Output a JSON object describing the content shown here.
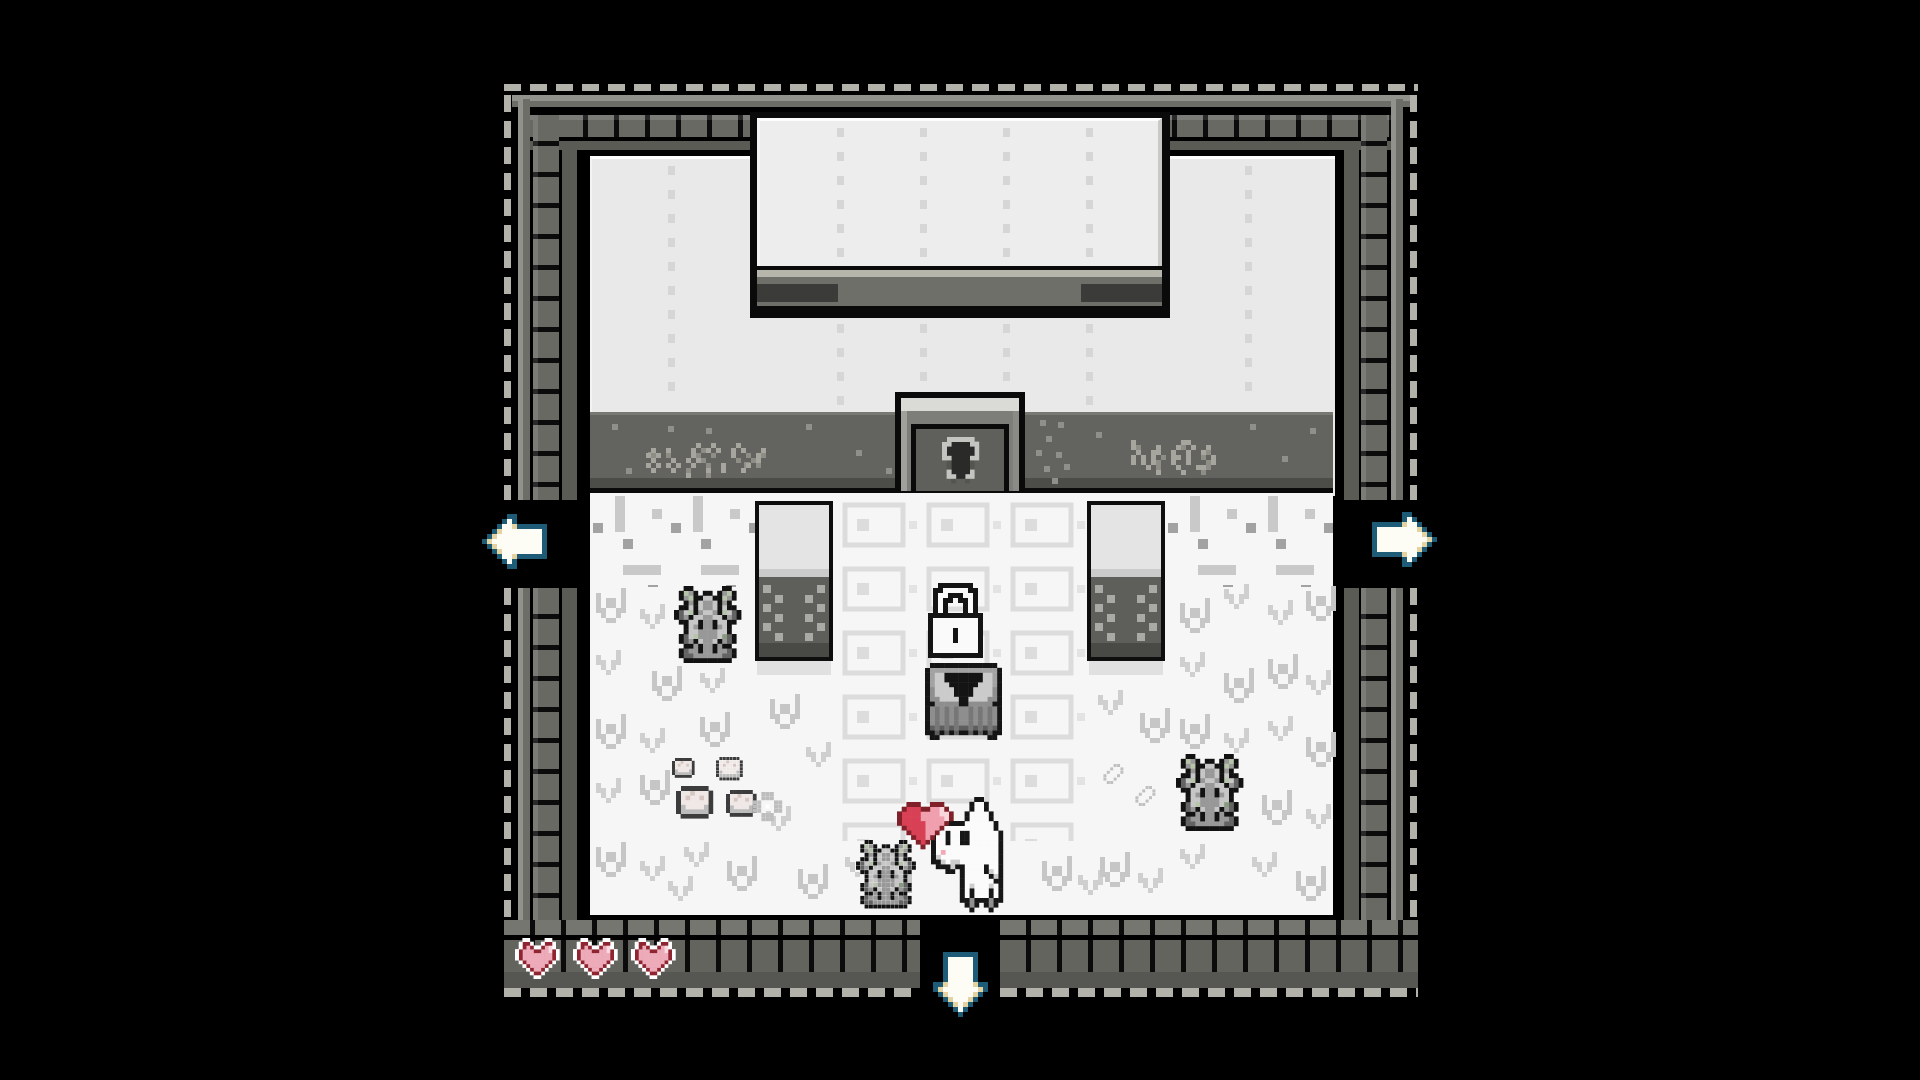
{
  "game": {
    "hud_hearts": 3,
    "door_locked": true,
    "exits": [
      "left",
      "right",
      "down"
    ]
  },
  "palette": {
    "background": "#000000",
    "frame_dash": "#b2b2aa",
    "frame_brick": "#696964",
    "wall": "#e9e9e9",
    "porch": "#63635f",
    "floor": "#f6f6f6",
    "heart_red": "#d84055",
    "heart_pink": "#f09fae",
    "hud_heart_ring": "#8f2531",
    "arrow_outline": "#1d5b76",
    "arrow_fill": "#fdfdf6",
    "arrow_tan": "#e4d2a0",
    "moss_green": "#b6c4aa"
  },
  "hud": {
    "hearts": 3,
    "x": 515,
    "y": 938,
    "spacing": 58,
    "scale": 3.7
  },
  "sprites": {
    "lock": {
      "palette": {
        "k": "#141414",
        "w": "#fafafa"
      },
      "rows": [
        "..kkkkkkk..",
        ".kkwwwwwkk.",
        ".kwwkkkwwk.",
        ".kwkk.kkwk.",
        ".kwk...kwk.",
        ".kwk...kwk.",
        "kkkkkkkkkkk",
        "kwwwwwwwwwk",
        "kwwwwwwwwwk",
        "kwwwwkwwwwk",
        "kwwwwkwwwwk",
        "kwwwwkwwwwk",
        "kwwwwwwwwwk",
        "kwwwwwwwwwk",
        "kkkkkkkkkkk"
      ]
    },
    "chest": {
      "palette": {
        "k": "#141414",
        "t": "#a2a2a2",
        "L": "#cbcbcb",
        "M": "#8e8e8e",
        "R": "#777777",
        "B": "#5e5e5e"
      },
      "rows": [
        ".kkkkkkkkkkkkkk.",
        "kttttttttttttttk",
        "ktLLkkkkkkkkLLtk",
        "ktLLkkkkkkkkLLtk",
        "ktLLLkkkkkkLLLtk",
        "kMLLLLkkkkLLLLMk",
        "kMLLLLkkkkLLLLMk",
        "kMMLLLLkkLLLLMMk",
        "kkMMMMMkkMMMMMkk",
        "kMRMRMRMMRMRMRMk",
        "kMRMRMRMMRMRMRMk",
        "kMRMRMRMMRMRMRMk",
        "kMRMRMRMMRMRMRMk",
        "kBRBRBRBBRBRBRBk",
        "kkBkBkBkkBkBkBkk",
        ".kk..........kk."
      ]
    },
    "statue": {
      "palette": {
        "k": "#121212",
        "A": "#989898",
        "B": "#c6c6c6",
        "D": "#636363",
        "m": "#b6c4aa",
        "n": "#87997e"
      },
      "rows": [
        "..kk......kk..",
        ".kmAk.kk.kAmk.",
        ".kAmkkBBkkmAk.",
        "..kAkBAABkAk..",
        ".kkBkBAABkBkk.",
        "kDBmkABBAkmBDk",
        "kDAkBBAABBkADk",
        ".kkBBkAAkBBkk.",
        "..kBAkAAkABk..",
        "..kBBAAAABBk..",
        ".kDBmAAAABnDk.",
        ".kDAkBAABkADk.",
        "..kkAkAAkAkk..",
        ".kDAAkAAkAADk.",
        ".kDDAAAAAADDk.",
        "..kkkkkkkkkk.."
      ]
    },
    "player": {
      "palette": {
        "k": "#161616",
        "w": "#fbfbfb",
        "s": "#cdcdcd",
        "p": "#f2a9b6",
        "d": "#8f8f8f"
      },
      "rows": [
        ".........kk.....",
        "........kwwk....",
        "........kwwk....",
        ".......kwwwwk...",
        ".......kwwwwk...",
        "..kkkkkwwwwwwk..",
        ".kwwwwwwwwwwwk..",
        "kwwkwwkkwwwwwwk.",
        "kwwkwwkkwwwwwwk.",
        "kwwkwwkkwwwwwwk.",
        "kwwwwwwwwwwwwwk.",
        "kwpwwwwwwwwwwwk.",
        "kswwwwwwwwwwwwk.",
        "kkswsswwwwwwwwk.",
        ".kkkskkwwwwkwwk.",
        "...kk.kwwwwkswk.",
        "......kwwwwwksk.",
        "......kwwwwwwkk.",
        "......kwswwwswk.",
        "......kwkwwwkwk.",
        "......kwkwwwkwk.",
        "......kkdkkkdkk.",
        ".......kdk.kdk..",
        "........k...k..."
      ]
    },
    "heart_float": {
      "palette": {
        "k": "#802028",
        "R": "#d84055",
        "P": "#f09fae",
        "W": "#f9d6db"
      },
      "rows": [
        "..kkk..kkk..",
        ".kRRRkkPPWk.",
        "kRRRRPPPPWWk",
        "kRRRRPPPPPWk",
        "kRRRRRPPPPk.",
        ".kRRRRPPPk..",
        "..kRRRPPk...",
        "...kRRPk....",
        "....kRk.....",
        ".....k......"
      ]
    },
    "hud_heart": {
      "palette": {
        "W": "#ffffff",
        "r": "#8f2531",
        "p": "#edaab8",
        "h": "#f8dae0"
      },
      "rows": [
        "..WW....WW..",
        ".WrrW..WrrW.",
        ".WrprWWrphW.",
        "WrppprrpphrW",
        "WrpppppppprW",
        "WrpppppppprW",
        ".WrpppppprW.",
        "..WrpppprW..",
        "...WrpprW...",
        "....WrrW....",
        ".....WW....."
      ]
    },
    "arrow_left": {
      "palette": {
        "t": "#1d5b76",
        "w": "#fdfdf6",
        "c": "#e4d2a0"
      },
      "rows": [
        ".....tt......",
        "....twt......",
        "...twwctttttt",
        "..tcwwwwwwwwt",
        ".tcwwwwwwwwwt",
        "tcwwwwwwwwwwt",
        ".tcwwwwwwwwwt",
        "..tcwwwwwwwwt",
        "...twwctttttt",
        "....twt......",
        ".....tt......"
      ]
    },
    "arrow_right": {
      "palette": {
        "t": "#1d5b76",
        "w": "#fdfdf6",
        "c": "#e4d2a0"
      },
      "rows": [
        "......tt.....",
        "......twt....",
        "ttttttcwwt...",
        "twwwwwwwwct..",
        "twwwwwwwwwct.",
        "twwwwwwwwwwct",
        "twwwwwwwwwct.",
        "twwwwwwwwct..",
        "ttttttcwwt...",
        "......twt....",
        "......tt....."
      ]
    },
    "arrow_down": {
      "palette": {
        "t": "#1d5b76",
        "w": "#fdfdf6",
        "c": "#e4d2a0"
      },
      "rows": [
        "..ttttttt..",
        "..twwwwwt..",
        "..twwwwwt..",
        "..twwwwwt..",
        "..twwwwwt..",
        "..twwwwwt..",
        "ttcwwwwwctt",
        "tcwwwwwwwct",
        ".tcwwwwwct.",
        "..tcwwwct..",
        "...tcwct...",
        "....twt....",
        ".....t....."
      ]
    },
    "keyhole": {
      "palette": {
        "K": "#c4c4c1",
        "k": "#2a2a28",
        "D": "#55554f"
      },
      "rows": [
        ".KKKKKK.",
        "KKkkkkKK",
        "KkkkkkkK",
        "KkkkkkkK",
        "KKkkkkKK",
        ".DkkkkD.",
        ".DkkkkD.",
        ".KkkkkK.",
        ".KKkkKK.",
        "..D..D.."
      ]
    },
    "pot": {
      "palette": {
        "o": "#3c3c3c",
        "f": "#f0e8e6",
        "q": "#d8c6c2",
        "G": "#bcbcbc"
      },
      "rows": [
        ".oooooo.",
        "offqfffo",
        "ofqffqfo",
        "offffffo",
        "oGffffGo",
        "oGGGGGGo",
        ".oooooo."
      ]
    },
    "flower": {
      "palette": {
        "g": "#bdbdbd",
        "w": "#ffffff"
      },
      "rows": [
        "..ggg...",
        "..ggg...",
        "gg...gg.",
        "gg.w.gg.",
        "gg...gg.",
        "..ggg...",
        "..ggg..."
      ]
    },
    "feather": {
      "palette": {
        "u": "#c0c0c0"
      },
      "rows": [
        "....uu..",
        "...u..u.",
        "..u...u.",
        ".u...u..",
        ".u..u...",
        "..uu...."
      ]
    },
    "tuft_a": {
      "palette": {
        "x": "#c6c6c6"
      },
      "rows": [
        "x....x",
        "x....x",
        "x.xx.x",
        "x.xx.x",
        "xx..xx",
        ".x..x.",
        "..xx.."
      ]
    },
    "tuft_b": {
      "palette": {
        "x": "#cfcfcf"
      },
      "rows": [
        "x...x",
        "x...x",
        "xx.xx",
        ".x.x.",
        "..x.."
      ]
    },
    "runes_left": {
      "palette": {
        "a": "#a6a69e",
        "b": "#8e8e86"
      },
      "rows": [
        "..........a..a....a",
        ".a..a....a.ba.a..a.a...a",
        "aba.b....ab..b...a..b.ab",
        ".a...a..a.ab......b..ba",
        "a.a.a.a..a..b..a....a.b",
        ".a...a..b...a..a...a",
        "........a...b"
      ]
    },
    "runes_right": {
      "palette": {
        "a": "#a6a69e",
        "b": "#8e8e86"
      },
      "rows": [
        ".a.........aa",
        ".ab...a...ab.a..a",
        "..a..aa..a..a..ab",
        ".a.a.a.b.aa.a..b.a",
        ".a.a.ab..a..a...ba",
        "....a.b...a...aab",
        "......a....a...b"
      ]
    }
  },
  "entities": [
    {
      "name": "sign-runes-left",
      "sprite": "runes_left",
      "x": 646,
      "y": 443,
      "scale": 5,
      "interactable": false
    },
    {
      "name": "sign-runes-right",
      "sprite": "runes_right",
      "x": 1126,
      "y": 440,
      "scale": 5,
      "interactable": false
    },
    {
      "name": "door-keyhole-icon",
      "sprite": "keyhole",
      "x": 942,
      "y": 437,
      "scale": 4.6,
      "interactable": false
    },
    {
      "name": "statue-gargoyle-left",
      "sprite": "statue",
      "x": 674,
      "y": 586,
      "scale": 4.8,
      "interactable": false
    },
    {
      "name": "statue-gargoyle-right",
      "sprite": "statue",
      "x": 1176,
      "y": 754,
      "scale": 4.8,
      "interactable": false
    },
    {
      "name": "pot-small",
      "sprite": "pot",
      "x": 672,
      "y": 758,
      "scale": 2.8,
      "interactable": false
    },
    {
      "name": "pot-small",
      "sprite": "pot",
      "x": 716,
      "y": 757,
      "scale": 3.4,
      "interactable": false
    },
    {
      "name": "pot-large",
      "sprite": "pot",
      "x": 676,
      "y": 786,
      "scale": 4.6,
      "interactable": false
    },
    {
      "name": "pot-large",
      "sprite": "pot",
      "x": 726,
      "y": 790,
      "scale": 3.8,
      "interactable": false
    },
    {
      "name": "flower-clover",
      "sprite": "flower",
      "x": 753,
      "y": 792,
      "scale": 4.2,
      "interactable": false
    },
    {
      "name": "feather-leaf",
      "sprite": "feather",
      "x": 1100,
      "y": 764,
      "scale": 3.4,
      "interactable": false
    },
    {
      "name": "feather-leaf",
      "sprite": "feather",
      "x": 1132,
      "y": 786,
      "scale": 3.4,
      "interactable": false
    },
    {
      "name": "padlock-icon",
      "sprite": "lock",
      "x": 928,
      "y": 583,
      "scale": 5,
      "interactable": false
    },
    {
      "name": "treasure-chest",
      "sprite": "chest",
      "x": 925,
      "y": 663,
      "scale": 4.8,
      "interactable": true
    },
    {
      "name": "statue-gargoyle-companion",
      "sprite": "statue",
      "x": 856,
      "y": 840,
      "scale": 4.3,
      "interactable": false
    },
    {
      "name": "player-character",
      "sprite": "player",
      "x": 931,
      "y": 797,
      "scale": 4.8,
      "interactable": false
    },
    {
      "name": "heart-bubble",
      "sprite": "heart_float",
      "x": 897,
      "y": 802,
      "scale": 4.7,
      "interactable": false
    },
    {
      "name": "exit-arrow-left",
      "sprite": "arrow_left",
      "x": 482,
      "y": 514,
      "scale": 5,
      "interactable": true
    },
    {
      "name": "exit-arrow-right",
      "sprite": "arrow_right",
      "x": 1372,
      "y": 512,
      "scale": 5,
      "interactable": true
    },
    {
      "name": "exit-arrow-down",
      "sprite": "arrow_down",
      "x": 933,
      "y": 952,
      "scale": 5,
      "interactable": true
    }
  ],
  "tufts": [
    [
      596,
      588,
      0
    ],
    [
      640,
      604,
      1
    ],
    [
      700,
      590,
      1
    ],
    [
      596,
      650,
      1
    ],
    [
      652,
      666,
      0
    ],
    [
      700,
      668,
      1
    ],
    [
      596,
      714,
      0
    ],
    [
      640,
      728,
      1
    ],
    [
      700,
      712,
      0
    ],
    [
      596,
      778,
      1
    ],
    [
      640,
      770,
      0
    ],
    [
      596,
      842,
      0
    ],
    [
      640,
      856,
      1
    ],
    [
      684,
      842,
      1
    ],
    [
      727,
      856,
      0
    ],
    [
      668,
      876,
      1
    ],
    [
      770,
      694,
      0
    ],
    [
      806,
      742,
      1
    ],
    [
      766,
      806,
      1
    ],
    [
      798,
      864,
      0
    ],
    [
      845,
      852,
      1
    ],
    [
      882,
      868,
      0
    ],
    [
      1042,
      856,
      0
    ],
    [
      1078,
      870,
      1
    ],
    [
      1098,
      690,
      1
    ],
    [
      1140,
      708,
      0
    ],
    [
      1100,
      852,
      0
    ],
    [
      1138,
      868,
      1
    ],
    [
      1180,
      598,
      0
    ],
    [
      1224,
      584,
      1
    ],
    [
      1268,
      600,
      1
    ],
    [
      1306,
      586,
      0
    ],
    [
      1180,
      652,
      1
    ],
    [
      1224,
      668,
      0
    ],
    [
      1268,
      654,
      0
    ],
    [
      1306,
      670,
      1
    ],
    [
      1180,
      714,
      0
    ],
    [
      1224,
      728,
      1
    ],
    [
      1268,
      716,
      1
    ],
    [
      1306,
      732,
      0
    ],
    [
      1262,
      790,
      0
    ],
    [
      1306,
      804,
      1
    ],
    [
      1252,
      852,
      1
    ],
    [
      1296,
      866,
      0
    ],
    [
      1180,
      844,
      1
    ]
  ],
  "speckles": [
    [
      612,
      424
    ],
    [
      648,
      452
    ],
    [
      706,
      428
    ],
    [
      744,
      462
    ],
    [
      806,
      424
    ],
    [
      856,
      450
    ],
    [
      886,
      468
    ],
    [
      1040,
      420
    ],
    [
      1058,
      422
    ],
    [
      1046,
      436
    ],
    [
      1036,
      450
    ],
    [
      1056,
      452
    ],
    [
      1044,
      466
    ],
    [
      1064,
      464
    ],
    [
      1052,
      478
    ],
    [
      1096,
      432
    ],
    [
      1250,
      424
    ],
    [
      1282,
      456
    ],
    [
      1310,
      428
    ],
    [
      626,
      468
    ],
    [
      668,
      426
    ]
  ],
  "dotted_columns": [
    [
      668,
      166,
      240
    ],
    [
      1245,
      166,
      240
    ],
    [
      837,
      128,
      140
    ],
    [
      920,
      128,
      140
    ],
    [
      1003,
      128,
      140
    ],
    [
      1086,
      128,
      140
    ],
    [
      837,
      324,
      82
    ],
    [
      920,
      324,
      66
    ],
    [
      1003,
      324,
      66
    ],
    [
      1086,
      324,
      82
    ]
  ]
}
